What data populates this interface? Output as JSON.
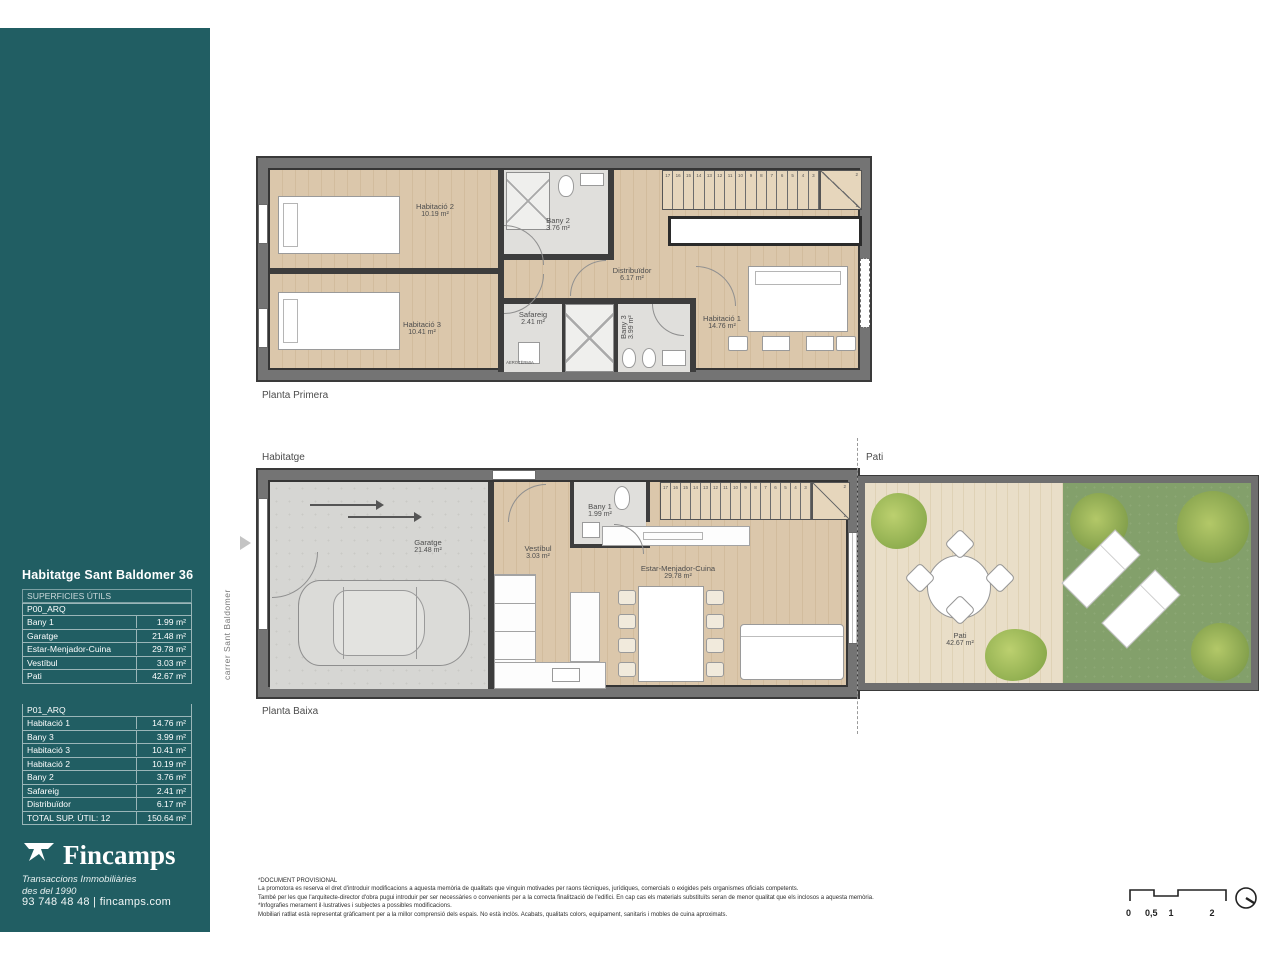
{
  "brand": {
    "teal": "#215e63",
    "name": "Fincamps",
    "tagline_line1": "Transaccions Immobiliàries",
    "tagline_line2": "des del 1990",
    "contact": "93 748 48 48  |  fincamps.com"
  },
  "sidebar": {
    "title": "Habitatge Sant Baldomer 36",
    "table": {
      "header": "SUPERFICIES ÚTILS",
      "sections": [
        {
          "name": "P00_ARQ",
          "rows": [
            {
              "label": "Bany 1",
              "value": "1.99 m²"
            },
            {
              "label": "Garatge",
              "value": "21.48 m²"
            },
            {
              "label": "Estar-Menjador-Cuina",
              "value": "29.78 m²"
            },
            {
              "label": "Vestíbul",
              "value": "3.03 m²"
            },
            {
              "label": "Pati",
              "value": "42.67 m²"
            }
          ]
        },
        {
          "name": "P01_ARQ",
          "rows": [
            {
              "label": "Habitació 1",
              "value": "14.76 m²"
            },
            {
              "label": "Bany 3",
              "value": "3.99 m²"
            },
            {
              "label": "Habitació 3",
              "value": "10.41 m²"
            },
            {
              "label": "Habitació 2",
              "value": "10.19 m²"
            },
            {
              "label": "Bany 2",
              "value": "3.76 m²"
            },
            {
              "label": "Safareig",
              "value": "2.41 m²"
            },
            {
              "label": "Distribuïdor",
              "value": "6.17 m²"
            }
          ]
        }
      ],
      "total": {
        "label": "TOTAL SUP. ÚTIL: 12",
        "value": "150.64 m²"
      }
    }
  },
  "plans": {
    "stair_numbers": [
      "17",
      "16",
      "15",
      "14",
      "13",
      "12",
      "11",
      "10",
      "9",
      "8",
      "7",
      "6",
      "5",
      "4",
      "3"
    ],
    "stair_winder": {
      "top": "2",
      "bottom": "1"
    },
    "first_floor": {
      "label": "Planta Primera",
      "aerotermia_label": "AEROTÈRMIA",
      "rooms": {
        "habitacio2": {
          "name": "Habitació 2",
          "area": "10.19 m²"
        },
        "habitacio3": {
          "name": "Habitació 3",
          "area": "10.41 m²"
        },
        "bany2": {
          "name": "Bany 2",
          "area": "3.76 m²"
        },
        "distribuidor": {
          "name": "Distribuïdor",
          "area": "6.17 m²"
        },
        "safareig": {
          "name": "Safareig",
          "area": "2.41 m²"
        },
        "bany3": {
          "name": "Bany 3",
          "area": "3.99 m²"
        },
        "habitacio1": {
          "name": "Habitació 1",
          "area": "14.76 m²"
        }
      }
    },
    "ground_floor": {
      "label": "Planta Baixa",
      "habitatge_label": "Habitatge",
      "pati_label": "Pati",
      "street_label": "carrer Sant Baldomer",
      "rooms": {
        "garatge": {
          "name": "Garatge",
          "area": "21.48 m²"
        },
        "vestibul": {
          "name": "Vestíbul",
          "area": "3.03 m²"
        },
        "bany1": {
          "name": "Bany 1",
          "area": "1.99 m²"
        },
        "estar": {
          "name": "Estar-Menjador-Cuina",
          "area": "29.78 m²"
        },
        "pati": {
          "name": "Pati",
          "area": "42.67 m²"
        }
      }
    }
  },
  "footer": {
    "disclaimer": [
      "*DOCUMENT PROVISIONAL",
      "La promotora es reserva el dret d'introduir modificacions a aquesta memòria de qualitats que vinguin motivades per raons tècniques, jurídiques, comercials o exigides pels organismes oficials competents.",
      "També per les que l'arquitecte-director d'obra pugui introduir per ser necessàries o convenients per a la correcta finalització de l'edifici. En cap cas els materials substituïts seran de menor qualitat que els inclosos a aquesta memòria.",
      "*Infografies merament il·lustratives i subjectes a possibles modificacions.",
      "Mobiliari ratllat està representat gràficament per a la millor comprensió dels espais. No està inclòs. Acabats, qualitats colors, equipament, sanitaris i mobles de cuina aproximats."
    ],
    "scale_ticks": [
      "0",
      "0,5",
      "1",
      "2"
    ]
  }
}
